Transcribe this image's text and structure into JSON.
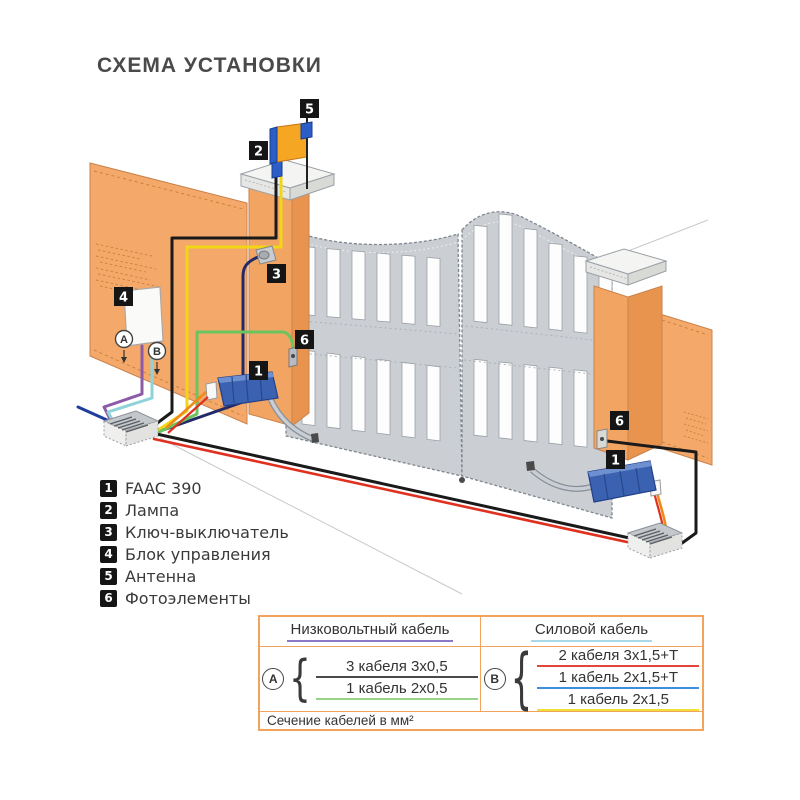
{
  "title": "СХЕМА УСТАНОВКИ",
  "legend": {
    "items": [
      {
        "num": "1",
        "label": "FAAC 390"
      },
      {
        "num": "2",
        "label": "Лампа"
      },
      {
        "num": "3",
        "label": "Ключ-выключатель"
      },
      {
        "num": "4",
        "label": "Блок управления"
      },
      {
        "num": "5",
        "label": "Антенна"
      },
      {
        "num": "6",
        "label": "Фотоэлементы"
      }
    ]
  },
  "diagram": {
    "markers": {
      "faac": "1",
      "lamp": "2",
      "key": "3",
      "unit": "4",
      "antenna": "5",
      "photo": "6"
    },
    "points": {
      "a": "A",
      "b": "B"
    },
    "colors": {
      "wall": "#F4A96B",
      "gate": "#CBCFD4",
      "motor": "#3A62B0",
      "wire_black": "#1A1A1A",
      "wire_red": "#E03020",
      "wire_yellow": "#F2D517",
      "wire_green": "#6CC45E",
      "wire_purple": "#8B5BA8",
      "wire_cyan": "#8FD2D8",
      "wire_orange": "#F08A18",
      "wire_navy": "#232B66"
    }
  },
  "table": {
    "headers": [
      {
        "text": "Низковольтный кабель",
        "u": "border-bottom-color:#8979C6"
      },
      {
        "text": "Силовой кабель",
        "u": "border-bottom-color:#A9D9E8"
      }
    ],
    "groups": [
      {
        "letter": "A",
        "rows": [
          {
            "text": "3 кабеля 3x0,5",
            "u": "border-bottom-color:#4A4A4A"
          },
          {
            "text": "1 кабель 2x0,5",
            "u": "border-bottom-color:#97D489"
          }
        ]
      },
      {
        "letter": "B",
        "rows": [
          {
            "text": "2 кабеля 3x1,5+T",
            "u": "border-bottom-color:#E3473C"
          },
          {
            "text": "1 кабель 2x1,5+T",
            "u": "border-bottom-color:#3E8EDE"
          },
          {
            "text": "1 кабель 2x1,5",
            "u": "border-bottom-color:#F0E03A"
          }
        ]
      }
    ],
    "footer": "Сечение кабелей в мм²"
  }
}
